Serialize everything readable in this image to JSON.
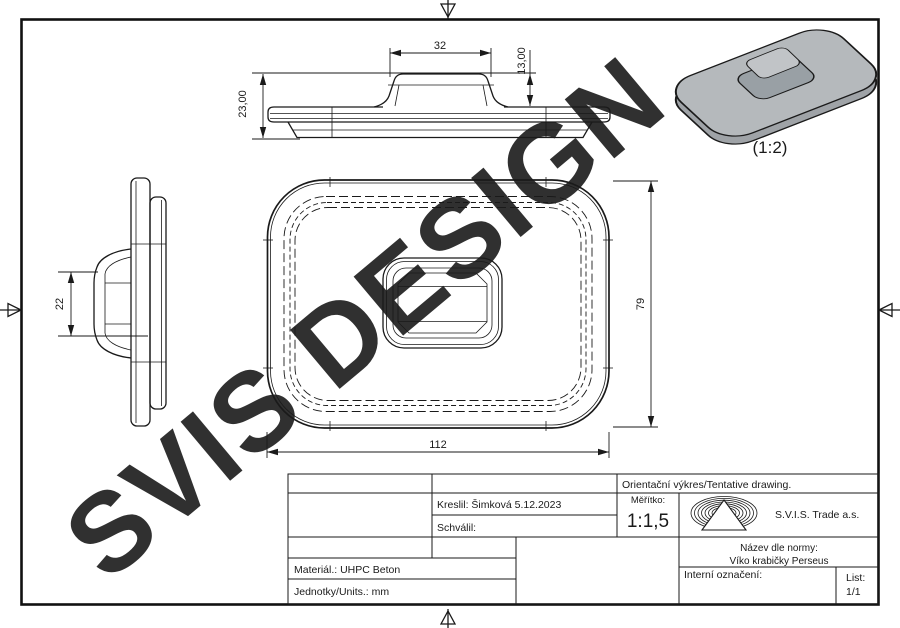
{
  "watermark": {
    "text": "SVIS DESIGN",
    "color": "#c2c2c2"
  },
  "drawing": {
    "front_view": {
      "dim_top_width": "32",
      "dim_bump_height": "13,00",
      "dim_total_height": "23,00"
    },
    "side_view": {
      "dim_bump_span": "22"
    },
    "plan_view": {
      "dim_width": "112",
      "dim_height": "79"
    },
    "iso_view": {
      "scale_label": "(1:2)"
    }
  },
  "title_block": {
    "tentative": "Orientační výkres/Tentative drawing.",
    "kreslil": "Kreslil: Šimková 5.12.2023",
    "schvalil": "Schválil:",
    "meritko_label": "Měřítko:",
    "meritko_value": "1:1,5",
    "company": "S.V.I.S. Trade a.s.",
    "nazev_label": "Název dle normy:",
    "nazev_value": "Víko krabičky Perseus",
    "interni": "Interní označení:",
    "list_label": "List:",
    "list_value": "1/1",
    "material": "Materiál.: UHPC Beton",
    "jednotky": "Jednotky/Units.: mm"
  },
  "colors": {
    "line": "#1a1a1a",
    "iso_plate": "#b5b9bc",
    "iso_rim": "#9fa3a7",
    "iso_bump_side": "#99a0a5",
    "iso_bump_top": "#c1c4c7"
  }
}
